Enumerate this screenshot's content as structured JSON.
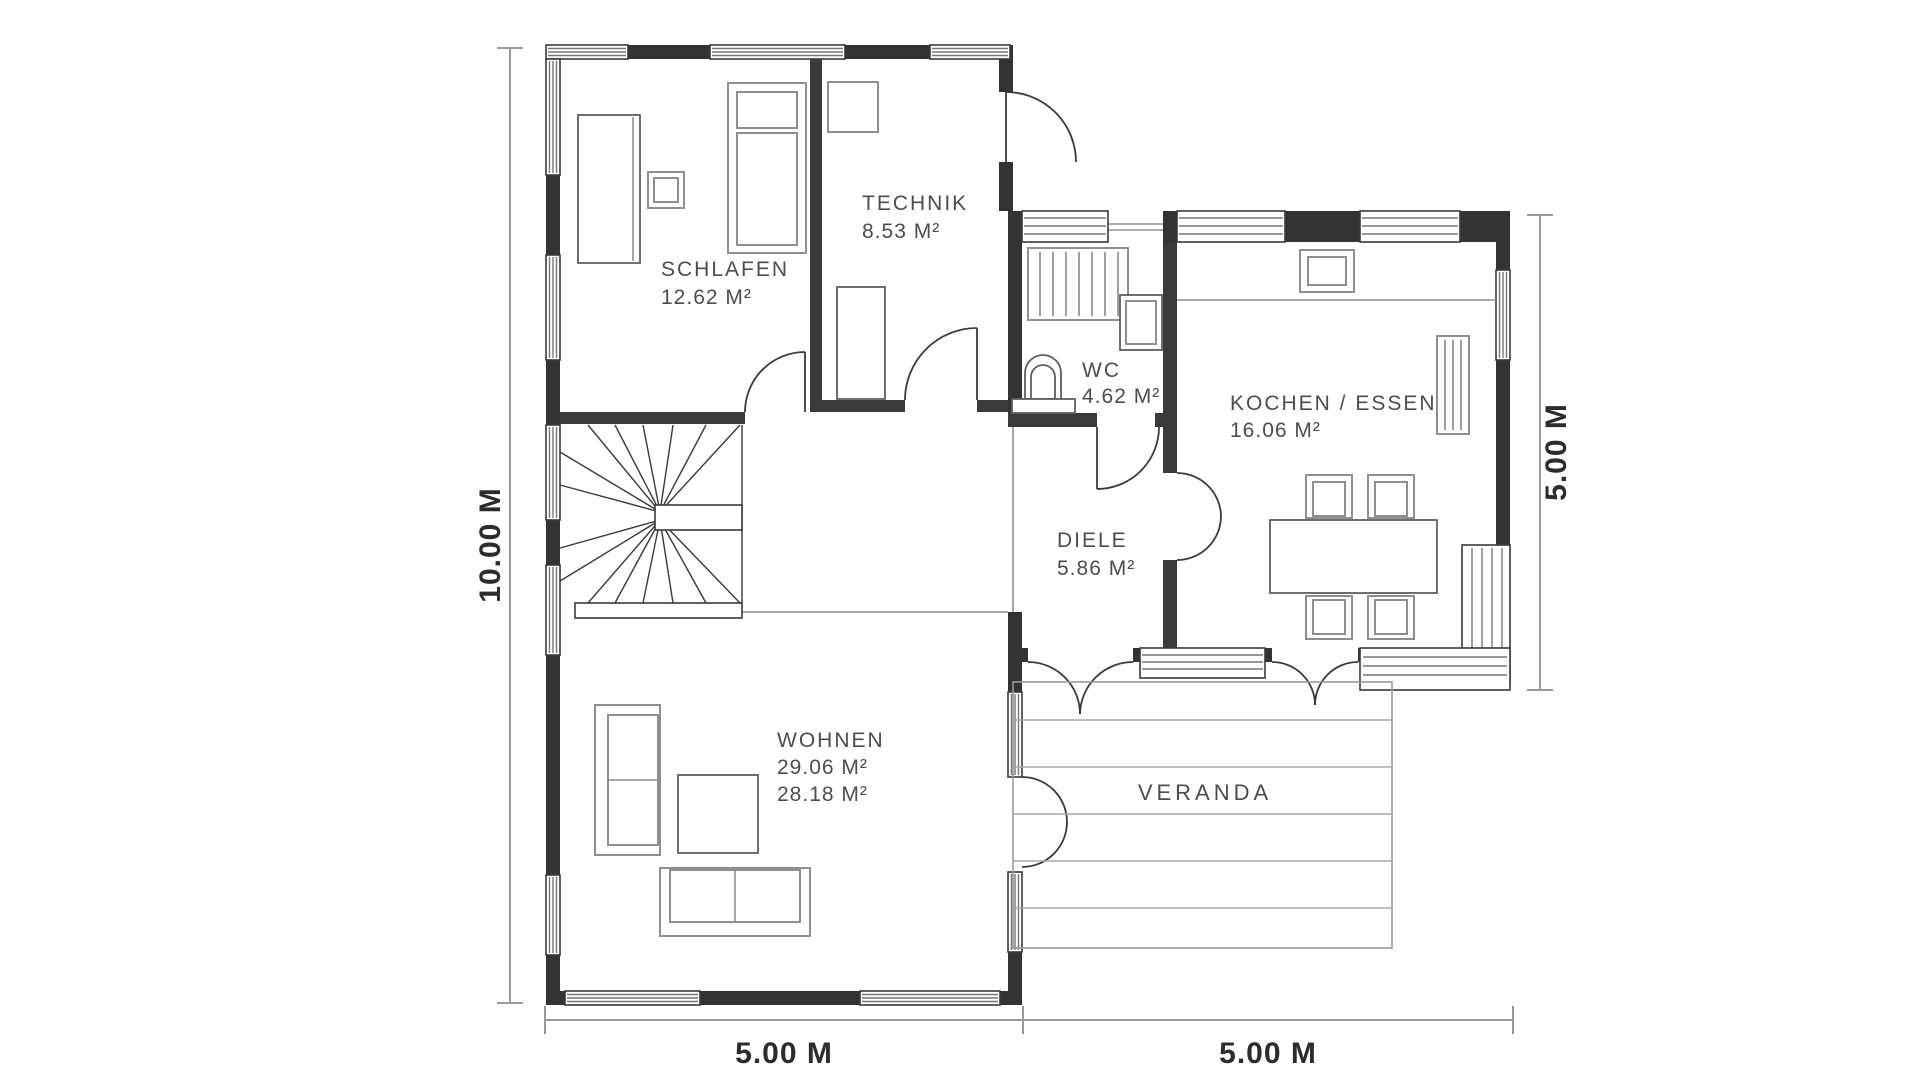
{
  "rooms": {
    "schlafen": {
      "name": "SCHLAFEN",
      "area": "12.62 M²"
    },
    "technik": {
      "name": "TECHNIK",
      "area": "8.53 M²"
    },
    "wc": {
      "name": "WC",
      "area": "4.62 M²"
    },
    "kochen": {
      "name": "KOCHEN / ESSEN",
      "area": "16.06 M²"
    },
    "diele": {
      "name": "DIELE",
      "area": "5.86 M²"
    },
    "wohnen": {
      "name": "WOHNEN",
      "area": "29.06 M²",
      "area2": "28.18 M²"
    },
    "veranda": {
      "name": "VERANDA"
    }
  },
  "dimensions": {
    "left": "10.00 M",
    "right": "5.00 M",
    "bottom_left": "5.00 M",
    "bottom_right": "5.00 M"
  },
  "colors": {
    "wall": "#333333",
    "furniture": "#8f8f8f",
    "dimension_text": "#2c2c2c",
    "room_label": "#4d4d4d"
  }
}
